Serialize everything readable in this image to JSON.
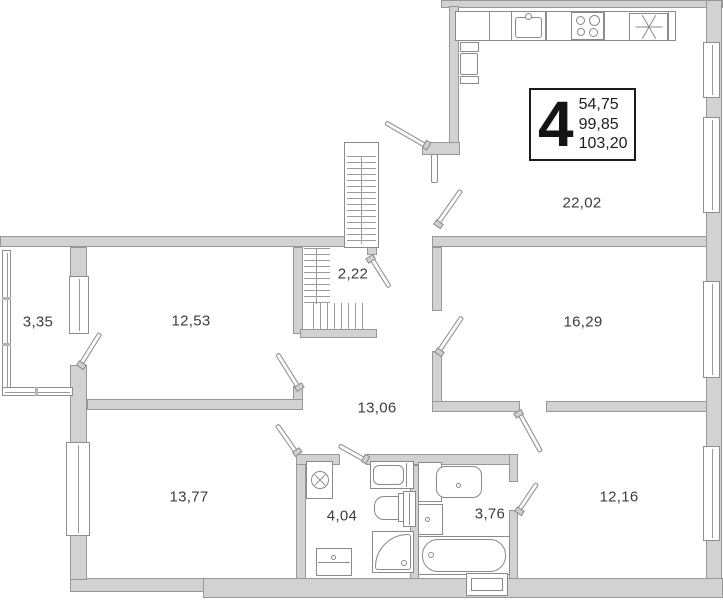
{
  "plan": {
    "type": "apartment-floor-plan",
    "unit_label": {
      "rooms_count": "4",
      "living_area": "54,75",
      "apartment_area": "99,85",
      "total_area": "103,20"
    },
    "rooms": [
      {
        "name": "kitchen-living-room",
        "area": "22,02"
      },
      {
        "name": "room-right-middle",
        "area": "16,29"
      },
      {
        "name": "room-right-bottom",
        "area": "12,16"
      },
      {
        "name": "hallway",
        "area": "13,06"
      },
      {
        "name": "room-left-middle",
        "area": "12,53"
      },
      {
        "name": "room-left-bottom",
        "area": "13,77"
      },
      {
        "name": "balcony",
        "area": "3,35"
      },
      {
        "name": "wardrobe",
        "area": "2,22"
      },
      {
        "name": "bathroom-left",
        "area": "4,04"
      },
      {
        "name": "bathroom-right",
        "area": "3,76"
      }
    ],
    "icons": [
      "kitchen-sink-icon",
      "stove-icon",
      "ventilation-icon",
      "fridge-icon",
      "washing-machine-icon",
      "toilet-icon",
      "towel-dryer-icon",
      "shower-icon",
      "washbasin-icon",
      "bathtub-icon",
      "cabinet-icon",
      "bathtub-shaft-icon"
    ]
  }
}
